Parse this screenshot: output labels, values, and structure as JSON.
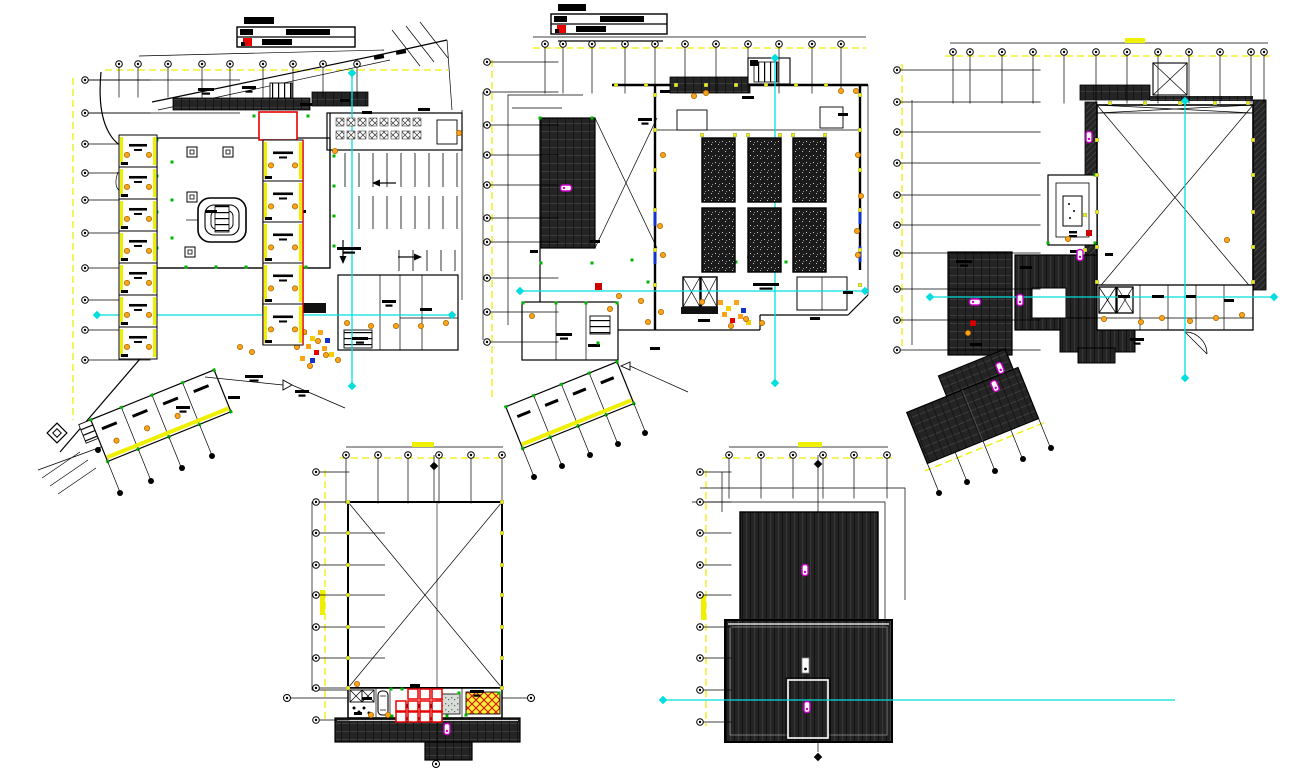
{
  "document": {
    "type": "cad-architectural-sheet",
    "views_count": 5,
    "background": "#ffffff"
  },
  "palette": {
    "line_black": "#000000",
    "dimension_yellow": "#efef00",
    "centerline_cyan": "#00dede",
    "marker_magenta": "#cc00cc",
    "accent_red": "#e80000",
    "door_orange": "#ffa418",
    "node_green": "#00b400",
    "detail_blue": "#1133cc",
    "roof_dark": "#242424"
  },
  "title_blocks": [
    {
      "plan": "plan-1",
      "rows": 2,
      "has_red_stamp": true
    },
    {
      "plan": "plan-2",
      "rows": 2,
      "has_red_stamp": true
    }
  ],
  "plans": [
    {
      "id": "plan-1",
      "name": "ground-floor-site-plan",
      "bubble_rows": [
        {
          "y": 64,
          "stub": 30,
          "xs": [
            119,
            138,
            168,
            202,
            230,
            263,
            293,
            323,
            357
          ]
        }
      ],
      "bubble_cols": [
        {
          "x": 85,
          "stub": 62,
          "ys": [
            80,
            113,
            144,
            173,
            200,
            233,
            268,
            300,
            330,
            360
          ]
        }
      ],
      "filled_bubbles": [
        [
          120,
          493
        ],
        [
          151,
          481
        ],
        [
          182,
          468
        ],
        [
          212,
          456
        ],
        [
          98,
          450
        ]
      ],
      "door_glyphs": [
        [
          335,
          151
        ],
        [
          459,
          133
        ],
        [
          240,
          347
        ],
        [
          252,
          352
        ],
        [
          304,
          332
        ],
        [
          318,
          341
        ],
        [
          326,
          355
        ],
        [
          297,
          347
        ],
        [
          347,
          323
        ],
        [
          371,
          326
        ],
        [
          396,
          326
        ],
        [
          421,
          326
        ],
        [
          446,
          323
        ],
        [
          128,
          349
        ],
        [
          310,
          366
        ],
        [
          338,
          360
        ]
      ],
      "green_nodes": [
        [
          172,
          162
        ],
        [
          172,
          200
        ],
        [
          172,
          238
        ],
        [
          186,
          267
        ],
        [
          216,
          267
        ],
        [
          246,
          267
        ],
        [
          276,
          267
        ],
        [
          306,
          267
        ],
        [
          157,
          140
        ],
        [
          157,
          176
        ],
        [
          157,
          212
        ],
        [
          157,
          248
        ],
        [
          334,
          156
        ],
        [
          334,
          186
        ],
        [
          334,
          216
        ],
        [
          334,
          246
        ],
        [
          308,
          116
        ],
        [
          254,
          116
        ]
      ],
      "yellow_nodes": [],
      "text_blobs": [
        [
          198,
          88,
          16
        ],
        [
          242,
          86,
          14
        ],
        [
          300,
          103,
          12
        ],
        [
          340,
          99,
          10
        ],
        [
          205,
          210,
          12
        ],
        [
          296,
          210,
          10
        ],
        [
          337,
          247,
          24
        ],
        [
          382,
          300,
          14
        ],
        [
          420,
          308,
          12
        ],
        [
          352,
          337,
          16
        ],
        [
          245,
          375,
          18
        ],
        [
          295,
          390,
          14
        ],
        [
          228,
          396,
          12
        ],
        [
          176,
          406,
          14
        ],
        [
          362,
          111,
          10
        ],
        [
          418,
          108,
          12
        ]
      ],
      "magenta_markers": [],
      "parking": [
        {
          "y0": 153,
          "y1": 187,
          "xs": [
            345,
            359,
            373,
            387,
            401,
            415,
            429,
            443,
            457
          ]
        },
        {
          "y0": 196,
          "y1": 229,
          "xs": [
            359,
            373,
            387,
            401,
            415,
            429,
            443,
            457
          ]
        },
        {
          "y0": 250,
          "y1": 271,
          "xs": [
            399,
            413,
            427,
            441,
            455
          ]
        }
      ],
      "table_grid": {
        "size": 8,
        "ys": [
          118,
          131
        ],
        "xs": [
          336,
          347,
          358,
          369,
          380,
          391,
          402,
          413
        ]
      },
      "left_rooms": {
        "x": 119,
        "w": 38,
        "y0": 135,
        "h": 32,
        "count": 7
      },
      "right_rooms": {
        "x": 263,
        "w": 40,
        "y0": 140,
        "h": 41,
        "count": 5
      }
    },
    {
      "id": "plan-2",
      "name": "first-floor-plan",
      "bubble_rows": [
        {
          "y": 44,
          "stub": 46,
          "xs": [
            545,
            563,
            592,
            625,
            655,
            685,
            716,
            748,
            779,
            812,
            841
          ]
        }
      ],
      "bubble_cols": [
        {
          "x": 487,
          "stub": 68,
          "ys": [
            62,
            92,
            125,
            155,
            185,
            218,
            242,
            278,
            312,
            342
          ]
        }
      ],
      "filled_bubbles": [
        [
          534,
          477
        ],
        [
          562,
          466
        ],
        [
          590,
          455
        ],
        [
          618,
          444
        ],
        [
          645,
          433
        ]
      ],
      "door_glyphs": [
        [
          619,
          296
        ],
        [
          641,
          301
        ],
        [
          661,
          312
        ],
        [
          702,
          302
        ],
        [
          731,
          326
        ],
        [
          746,
          319
        ],
        [
          762,
          323
        ],
        [
          805,
          256
        ],
        [
          857,
          231
        ],
        [
          660,
          226
        ],
        [
          861,
          196
        ],
        [
          841,
          91
        ],
        [
          856,
          91
        ],
        [
          694,
          96
        ],
        [
          706,
          93
        ],
        [
          532,
          316
        ],
        [
          610,
          309
        ],
        [
          648,
          322
        ],
        [
          750,
          257
        ],
        [
          663,
          155
        ],
        [
          858,
          155
        ],
        [
          663,
          255
        ],
        [
          858,
          255
        ]
      ],
      "green_nodes": [
        [
          523,
          303
        ],
        [
          556,
          303
        ],
        [
          586,
          303
        ],
        [
          617,
          303
        ],
        [
          541,
          263
        ],
        [
          592,
          263
        ],
        [
          540,
          118
        ],
        [
          592,
          118
        ],
        [
          632,
          260
        ],
        [
          648,
          282
        ],
        [
          736,
          262
        ],
        [
          786,
          262
        ],
        [
          598,
          343
        ]
      ],
      "yellow_nodes": [
        [
          655,
          95
        ],
        [
          655,
          130
        ],
        [
          655,
          170
        ],
        [
          655,
          210
        ],
        [
          655,
          250
        ],
        [
          655,
          285
        ],
        [
          860,
          95
        ],
        [
          860,
          130
        ],
        [
          860,
          170
        ],
        [
          860,
          210
        ],
        [
          860,
          250
        ],
        [
          860,
          285
        ],
        [
          676,
          85
        ],
        [
          706,
          85
        ],
        [
          736,
          85
        ],
        [
          766,
          85
        ],
        [
          796,
          85
        ],
        [
          826,
          85
        ],
        [
          616,
          85
        ],
        [
          646,
          85
        ],
        [
          702,
          135
        ],
        [
          735,
          135
        ],
        [
          748,
          135
        ],
        [
          780,
          135
        ],
        [
          793,
          135
        ],
        [
          825,
          135
        ]
      ],
      "text_blobs": [
        [
          638,
          118,
          14
        ],
        [
          742,
          96,
          12
        ],
        [
          838,
          113,
          10
        ],
        [
          698,
          319,
          12
        ],
        [
          556,
          333,
          16
        ],
        [
          588,
          344,
          12
        ],
        [
          753,
          283,
          26
        ],
        [
          843,
          291,
          10
        ],
        [
          810,
          317,
          10
        ],
        [
          650,
          347,
          10
        ],
        [
          660,
          90,
          10
        ],
        [
          590,
          240,
          10
        ],
        [
          530,
          250,
          8
        ]
      ],
      "magenta_markers": [
        [
          566,
          188,
          90
        ]
      ],
      "planters": {
        "xs": [
          702,
          748,
          793
        ],
        "ys": [
          138,
          208
        ],
        "w": 33,
        "h": 64
      }
    },
    {
      "id": "plan-3",
      "name": "roof-plan",
      "bubble_rows": [
        {
          "y": 52,
          "stub": 48,
          "xs": [
            953,
            970,
            1002,
            1033,
            1064,
            1096,
            1127,
            1158,
            1189,
            1220,
            1251,
            1264
          ]
        }
      ],
      "bubble_cols": [
        {
          "x": 897,
          "stub": 140,
          "ys": [
            70,
            102,
            132,
            163,
            195,
            225,
            253,
            289,
            320,
            350
          ]
        }
      ],
      "filled_bubbles": [
        [
          939,
          493
        ],
        [
          967,
          482
        ],
        [
          995,
          471
        ],
        [
          1023,
          459
        ],
        [
          1051,
          448
        ]
      ],
      "door_glyphs": [
        [
          1104,
          319
        ],
        [
          1141,
          322
        ],
        [
          1162,
          318
        ],
        [
          1190,
          321
        ],
        [
          1216,
          318
        ],
        [
          1242,
          315
        ],
        [
          1068,
          239
        ],
        [
          968,
          333
        ],
        [
          1227,
          240
        ]
      ],
      "green_nodes": [
        [
          1048,
          243
        ],
        [
          1095,
          175
        ],
        [
          1095,
          243
        ]
      ],
      "yellow_nodes": [
        [
          1097,
          140
        ],
        [
          1097,
          175
        ],
        [
          1097,
          212
        ],
        [
          1097,
          247
        ],
        [
          1097,
          282
        ],
        [
          1253,
          140
        ],
        [
          1253,
          175
        ],
        [
          1253,
          212
        ],
        [
          1253,
          247
        ],
        [
          1253,
          282
        ],
        [
          1110,
          103
        ],
        [
          1145,
          103
        ],
        [
          1180,
          103
        ],
        [
          1215,
          103
        ],
        [
          1248,
          103
        ],
        [
          1085,
          215
        ],
        [
          1085,
          250
        ]
      ],
      "text_blobs": [
        [
          956,
          260,
          16
        ],
        [
          1020,
          266,
          12
        ],
        [
          1118,
          295,
          12
        ],
        [
          1152,
          295,
          12
        ],
        [
          1186,
          295,
          10
        ],
        [
          1224,
          299,
          10
        ],
        [
          1130,
          338,
          14
        ],
        [
          970,
          343,
          12
        ],
        [
          1070,
          250,
          10
        ],
        [
          1105,
          253,
          8
        ]
      ],
      "magenta_markers": [
        [
          1089,
          137,
          0
        ],
        [
          975,
          302,
          90
        ],
        [
          1020,
          300,
          0
        ],
        [
          1080,
          255,
          0
        ],
        [
          1000,
          368,
          -22
        ],
        [
          995,
          386,
          -22
        ]
      ]
    },
    {
      "id": "plan-4",
      "name": "terrace-machine-room-plan",
      "bubble_rows": [
        {
          "y": 455,
          "stub": 45,
          "xs": [
            346,
            378,
            408,
            439,
            471,
            502
          ]
        }
      ],
      "bubble_cols": [
        {
          "x": 316,
          "stub": 30,
          "ys": [
            472,
            502,
            533,
            565,
            595,
            627,
            658,
            688,
            720
          ]
        }
      ],
      "door_glyphs": [
        [
          371,
          715
        ],
        [
          388,
          715
        ],
        [
          357,
          684
        ]
      ],
      "green_nodes": [
        [
          391,
          689
        ],
        [
          402,
          689
        ],
        [
          440,
          691
        ],
        [
          459,
          693
        ],
        [
          466,
          715
        ],
        [
          499,
          693
        ],
        [
          447,
          716
        ],
        [
          392,
          716
        ]
      ],
      "yellow_nodes": [
        [
          348,
          502
        ],
        [
          348,
          533
        ],
        [
          348,
          565
        ],
        [
          348,
          595
        ],
        [
          348,
          627
        ],
        [
          348,
          658
        ],
        [
          348,
          688
        ],
        [
          502,
          502
        ],
        [
          502,
          533
        ],
        [
          502,
          565
        ],
        [
          502,
          595
        ],
        [
          502,
          627
        ],
        [
          502,
          658
        ],
        [
          502,
          688
        ]
      ],
      "text_blobs": [
        [
          362,
          697,
          10
        ],
        [
          470,
          690,
          14
        ],
        [
          410,
          684,
          10
        ],
        [
          354,
          712,
          8
        ]
      ],
      "magenta_markers": [
        [
          447,
          729,
          0
        ]
      ],
      "red_squares": {
        "size": 10,
        "rows": [
          {
            "y": 689,
            "xs": [
              408,
              420,
              432
            ]
          },
          {
            "y": 701,
            "xs": [
              396,
              408,
              420,
              432
            ]
          },
          {
            "y": 712,
            "xs": [
              396,
              408,
              420,
              432
            ]
          }
        ]
      }
    },
    {
      "id": "plan-5",
      "name": "upper-roof-plan",
      "bubble_rows": [
        {
          "y": 455,
          "stub": 40,
          "xs": [
            729,
            761,
            793,
            823,
            854,
            887
          ]
        }
      ],
      "bubble_cols": [
        {
          "x": 700,
          "stub": 28,
          "ys": [
            472,
            502,
            533,
            565,
            595,
            627,
            658,
            690,
            722
          ]
        }
      ],
      "text_blobs": [],
      "magenta_markers": [
        [
          805,
          570,
          0
        ],
        [
          807,
          707,
          0
        ]
      ]
    }
  ]
}
